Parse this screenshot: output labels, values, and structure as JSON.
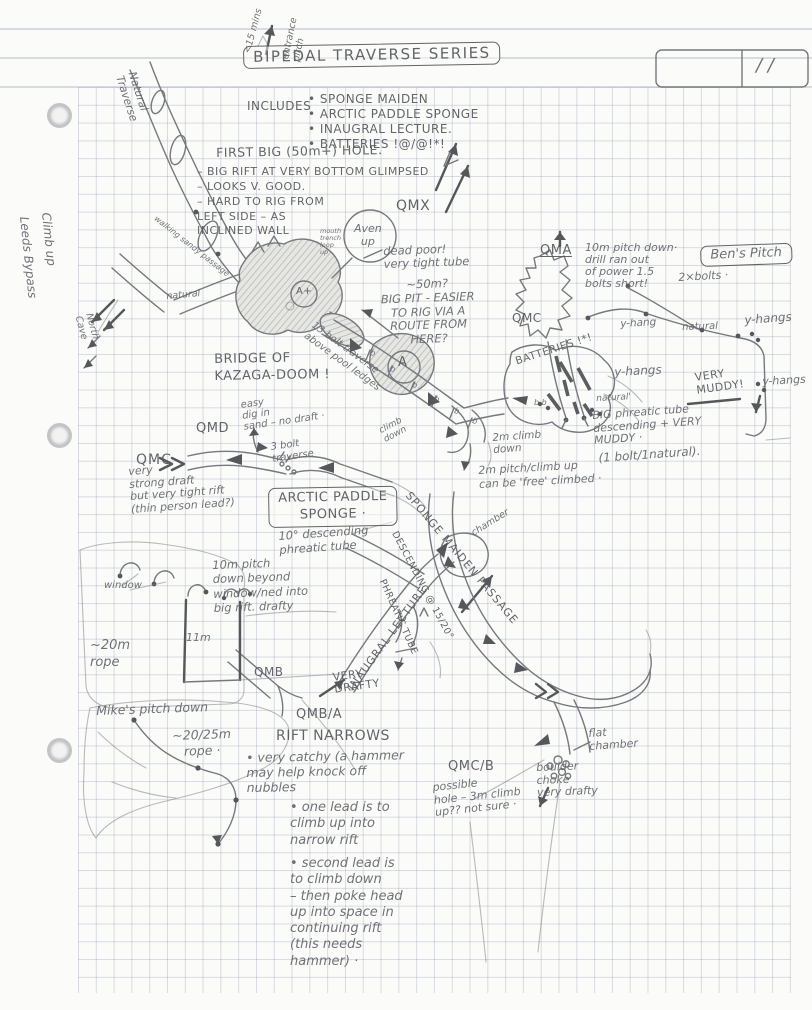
{
  "page": {
    "pencil_color": "#63676c",
    "paper_color": "#fbfbf9",
    "grid_color": "#919cb2"
  },
  "labels": [
    {
      "id": "title",
      "t": "BIPEDAL TRAVERSE SERIES",
      "x": 243,
      "y": 46,
      "s": 15,
      "r": -1,
      "cls": "box caps",
      "ls": 1.5
    },
    {
      "id": "includes-lead",
      "t": "INCLUDES",
      "x": 247,
      "y": 100,
      "s": 12,
      "cls": "caps"
    },
    {
      "id": "includes-items",
      "t": "• SPONGE MAIDEN\n• ARCTIC PADDLE SPONGE\n• INAUGRAL LECTURE.\n• BATTERIES !@/@!*!",
      "x": 308,
      "y": 92,
      "s": 12,
      "cls": "caps",
      "lh": 1.25
    },
    {
      "id": "date-slashes",
      "t": "/   /",
      "x": 756,
      "y": 56,
      "s": 18
    },
    {
      "id": "entrance-pitch",
      "t": "entrance\npitch",
      "x": 280,
      "y": 58,
      "s": 9.5,
      "r": -78,
      "lh": 1.2
    },
    {
      "id": "fifteen-mins",
      "t": "<15 mins",
      "x": 243,
      "y": 52,
      "s": 9.5,
      "r": -75
    },
    {
      "id": "natural-traverse",
      "t": "Natural\nTraverse",
      "x": 138,
      "y": 70,
      "s": 11,
      "r": 72,
      "lh": 1.2
    },
    {
      "id": "climb-up",
      "t": "Climb up",
      "x": 52,
      "y": 212,
      "s": 12,
      "r": 84
    },
    {
      "id": "leeds-bypass",
      "t": "Leeds Bypass",
      "x": 30,
      "y": 216,
      "s": 12,
      "r": 84
    },
    {
      "id": "north-cave",
      "t": "North\nCave",
      "x": 94,
      "y": 312,
      "s": 9.5,
      "r": 75,
      "lh": 1.2
    },
    {
      "id": "walking-passage",
      "t": "walking sandy passage",
      "x": 158,
      "y": 214,
      "s": 8,
      "r": 38
    },
    {
      "id": "natural-small-1",
      "t": "natural",
      "x": 166,
      "y": 292,
      "s": 9.5,
      "r": -5
    },
    {
      "id": "fbh-title",
      "t": "FIRST BIG (50m+) HOLE.",
      "x": 216,
      "y": 146,
      "s": 12.5,
      "cls": "caps",
      "r": -1
    },
    {
      "id": "fbh-notes",
      "t": "– BIG RIFT AT VERY BOTTOM GLIMPSED\n– LOOKS V. GOOD.\n– HARD TO RIG FROM\n   LEFT SIDE – AS\n   INCLINED WALL",
      "x": 197,
      "y": 165,
      "s": 11,
      "cls": "caps",
      "lh": 1.35
    },
    {
      "id": "qmx",
      "t": "QMX",
      "x": 396,
      "y": 198,
      "s": 14,
      "cls": "caps"
    },
    {
      "id": "aven-up",
      "t": "Aven\nup",
      "x": 354,
      "y": 222,
      "s": 11,
      "ta": "center",
      "lh": 1.2
    },
    {
      "id": "mouth-trench",
      "t": "mouth\ntrench\nloop\nup",
      "x": 320,
      "y": 228,
      "s": 6.5,
      "lh": 1.1
    },
    {
      "id": "dead-poor",
      "t": "dead poor!\nvery tight tube",
      "x": 383,
      "y": 245,
      "s": 11.5,
      "r": -2
    },
    {
      "id": "big-pit-note",
      "t": "~50m?\nBIG PIT - EASIER\nTO RIG VIA A\nROUTE FROM\nHERE?",
      "x": 362,
      "y": 280,
      "s": 11.5,
      "r": -2,
      "lh": 1.2,
      "ta": "center",
      "w": 130
    },
    {
      "id": "qma",
      "t": "QMA",
      "x": 540,
      "y": 244,
      "s": 13,
      "cls": "caps underline"
    },
    {
      "id": "qma-note",
      "t": "10m pitch down·\ndrill ran out\nof power 1.5\nbolts short!",
      "x": 585,
      "y": 242,
      "s": 11,
      "lh": 1.1
    },
    {
      "id": "bens-pitch",
      "t": "Ben's Pitch",
      "x": 700,
      "y": 246,
      "s": 13,
      "cls": "box",
      "r": -2
    },
    {
      "id": "two-bolts",
      "t": "2×bolts ·",
      "x": 678,
      "y": 272,
      "s": 11,
      "r": -3
    },
    {
      "id": "qmc-right",
      "t": "QMC",
      "x": 512,
      "y": 312,
      "s": 12,
      "cls": "caps"
    },
    {
      "id": "yhang-1",
      "t": "y-hang",
      "x": 620,
      "y": 318,
      "s": 10.5,
      "r": -3
    },
    {
      "id": "natural-2",
      "t": "natural",
      "x": 682,
      "y": 322,
      "s": 10,
      "r": -2
    },
    {
      "id": "yhangs-2",
      "t": "y-hangs",
      "x": 744,
      "y": 314,
      "s": 12,
      "r": -4
    },
    {
      "id": "yhangs-3",
      "t": "y-hangs",
      "x": 614,
      "y": 366,
      "s": 12,
      "r": -3
    },
    {
      "id": "very-muddy",
      "t": "VERY\nMUDDY!",
      "x": 694,
      "y": 372,
      "s": 11,
      "r": -8,
      "cls": "caps",
      "lh": 1.15
    },
    {
      "id": "yhangs-4",
      "t": "y-hangs",
      "x": 762,
      "y": 376,
      "s": 11,
      "r": -3
    },
    {
      "id": "natural-3",
      "t": "natural'",
      "x": 596,
      "y": 394,
      "s": 9,
      "r": -3
    },
    {
      "id": "bridge",
      "t": "BRIDGE OF\nKAZAGA-DOOM !",
      "x": 214,
      "y": 352,
      "s": 13,
      "cls": "caps",
      "lh": 1.3,
      "r": -1
    },
    {
      "id": "bolt-traverse",
      "t": "13 bolt traverse\nabove pool ledges",
      "x": 316,
      "y": 320,
      "s": 10,
      "r": 36,
      "lh": 1.25
    },
    {
      "id": "batteries-label",
      "t": "BATTERIES !*!",
      "x": 514,
      "y": 356,
      "s": 10.5,
      "r": -18,
      "cls": "caps"
    },
    {
      "id": "big-phreatic",
      "t": "BIG phreatic tube\ndescending + VERY\n        MUDDY ·",
      "x": 592,
      "y": 410,
      "s": 11,
      "r": -4,
      "lh": 1.15
    },
    {
      "id": "climb-down-2m",
      "t": "2m climb\ndown",
      "x": 492,
      "y": 432,
      "s": 10.5,
      "r": -4
    },
    {
      "id": "pitch-2m-paren",
      "t": "(1 bolt/1natural).",
      "x": 598,
      "y": 452,
      "s": 12,
      "r": -4
    },
    {
      "id": "pitch-2m",
      "t": "2m pitch/climb up\ncan be 'free' climbed ·",
      "x": 478,
      "y": 464,
      "s": 11,
      "r": -3,
      "lh": 1.3
    },
    {
      "id": "qmd",
      "t": "QMD",
      "x": 196,
      "y": 422,
      "s": 13,
      "cls": "caps"
    },
    {
      "id": "qmd-note",
      "t": "easy\ndig in\nsand – no draft ·",
      "x": 240,
      "y": 400,
      "s": 10,
      "r": -8,
      "lh": 1.1
    },
    {
      "id": "qmc-left",
      "t": "QMC",
      "x": 136,
      "y": 452,
      "s": 14,
      "cls": "caps",
      "ls": 1
    },
    {
      "id": "strong-draft",
      "t": "very\nstrong draft\nbut very tight rift\n(thin person lead?)",
      "x": 128,
      "y": 466,
      "s": 11,
      "r": -4,
      "lh": 1.15
    },
    {
      "id": "three-bolt",
      "t": "3 bolt\ntraverse",
      "x": 270,
      "y": 442,
      "s": 10,
      "r": -8,
      "lh": 1.15
    },
    {
      "id": "climb-down-c",
      "t": "climb\ndown",
      "x": 378,
      "y": 428,
      "s": 9,
      "r": -28,
      "lh": 1.1
    },
    {
      "id": "arctic",
      "t": "ARCTIC PADDLE\nSPONGE ·",
      "x": 268,
      "y": 488,
      "s": 13,
      "cls": "box caps",
      "ta": "center",
      "lh": 1.3,
      "r": -1
    },
    {
      "id": "ten-deg",
      "t": "10° descending\nphreatic tube",
      "x": 278,
      "y": 530,
      "s": 11.5,
      "r": -4,
      "lh": 1.2
    },
    {
      "id": "chamber",
      "t": "chamber",
      "x": 470,
      "y": 530,
      "s": 9.5,
      "r": -32
    },
    {
      "id": "inaugral",
      "t": "INAUGRAL LECTURE",
      "x": 346,
      "y": 686,
      "s": 11,
      "r": -54,
      "cls": "caps",
      "ls": 1
    },
    {
      "id": "sponge-maiden",
      "t": "SPONGE MAIDEN PASSAGE",
      "x": 412,
      "y": 490,
      "s": 11,
      "r": 50,
      "cls": "caps",
      "ls": 1
    },
    {
      "id": "descending-15-20",
      "t": "DESCENDING @ 15/20°",
      "x": 398,
      "y": 530,
      "s": 9.5,
      "r": 62,
      "cls": "caps"
    },
    {
      "id": "phreatic-tube",
      "t": "PHREATIC TUBE",
      "x": 386,
      "y": 578,
      "s": 9.5,
      "r": 66,
      "cls": "caps"
    },
    {
      "id": "ten-m-pitch",
      "t": "10m pitch\ndown beyond\nwindow/ned into\nbig rift. drafty",
      "x": 212,
      "y": 558,
      "s": 11.5,
      "lh": 1.25,
      "r": -2
    },
    {
      "id": "window",
      "t": "window",
      "x": 104,
      "y": 580,
      "s": 10
    },
    {
      "id": "eleven-m",
      "t": "11m",
      "x": 186,
      "y": 632,
      "s": 11
    },
    {
      "id": "rope-20",
      "t": "~20m\nrope",
      "x": 90,
      "y": 638,
      "s": 13,
      "lh": 1.3
    },
    {
      "id": "mikes",
      "t": "Mike's pitch down",
      "x": 96,
      "y": 704,
      "s": 12.5,
      "r": -2
    },
    {
      "id": "mikes-rope",
      "t": "~20/25m\nrope ·",
      "x": 172,
      "y": 728,
      "s": 12.5,
      "r": -2,
      "lh": 1.25,
      "ta": "center"
    },
    {
      "id": "qmb",
      "t": "QMB",
      "x": 254,
      "y": 666,
      "s": 12,
      "cls": "caps"
    },
    {
      "id": "very-drafty",
      "t": "VERY\nDRAFTY",
      "x": 332,
      "y": 672,
      "s": 11,
      "r": -8,
      "cls": "caps",
      "lh": 1.1
    },
    {
      "id": "qmb-a",
      "t": "QMB/A",
      "x": 296,
      "y": 708,
      "s": 13,
      "cls": "caps"
    },
    {
      "id": "rift-narrows",
      "t": "RIFT NARROWS",
      "x": 276,
      "y": 728,
      "s": 14,
      "cls": "caps"
    },
    {
      "id": "rift-note-1",
      "t": "• very catchy (a hammer\nmay help knock off\nnubbles",
      "x": 246,
      "y": 750,
      "s": 12.5,
      "lh": 1.2,
      "r": -1
    },
    {
      "id": "rift-note-2",
      "t": "• one lead is to\nclimb up into\nnarrow rift",
      "x": 290,
      "y": 800,
      "s": 13,
      "lh": 1.25
    },
    {
      "id": "rift-note-3",
      "t": "• second lead is\nto climb down\n– then poke head\nup into space in\ncontinuing rift\n(this needs\n  hammer) ·",
      "x": 290,
      "y": 856,
      "s": 13,
      "lh": 1.25
    },
    {
      "id": "qmcb",
      "t": "QMC/B",
      "x": 448,
      "y": 760,
      "s": 13,
      "cls": "caps"
    },
    {
      "id": "qmcb-note",
      "t": "possible\nhole – 3m climb\nup?? not sure ·",
      "x": 432,
      "y": 782,
      "s": 11,
      "r": -6,
      "lh": 1.15
    },
    {
      "id": "boulder-choke",
      "t": "boulder\nchoke\nvery drafty",
      "x": 536,
      "y": 762,
      "s": 11,
      "lh": 1.15,
      "r": -2
    },
    {
      "id": "flat-chamber",
      "t": "flat\nchamber",
      "x": 588,
      "y": 728,
      "s": 11,
      "r": -4,
      "lh": 1.15
    },
    {
      "id": "hole-a-plus",
      "t": "A+",
      "x": 296,
      "y": 286,
      "s": 10,
      "cls": "caps"
    },
    {
      "id": "hole-a",
      "t": "A",
      "x": 398,
      "y": 356,
      "s": 13,
      "cls": "caps"
    },
    {
      "id": "bolt-b-1",
      "t": "b",
      "x": 372,
      "y": 348,
      "s": 8,
      "r": 20
    },
    {
      "id": "bolt-b-2",
      "t": "b",
      "x": 392,
      "y": 364,
      "s": 8,
      "r": 20
    },
    {
      "id": "bolt-b-3",
      "t": "b",
      "x": 414,
      "y": 380,
      "s": 8,
      "r": 20
    },
    {
      "id": "bolt-b-4",
      "t": "b",
      "x": 436,
      "y": 394,
      "s": 8,
      "r": 20
    },
    {
      "id": "bolt-b-5",
      "t": "b",
      "x": 456,
      "y": 406,
      "s": 8,
      "r": 20
    },
    {
      "id": "bolt-b-6",
      "t": "b",
      "x": 474,
      "y": 416,
      "s": 8,
      "r": 20
    },
    {
      "id": "bolt-bb",
      "t": "b  b",
      "x": 534,
      "y": 398,
      "s": 8
    }
  ]
}
